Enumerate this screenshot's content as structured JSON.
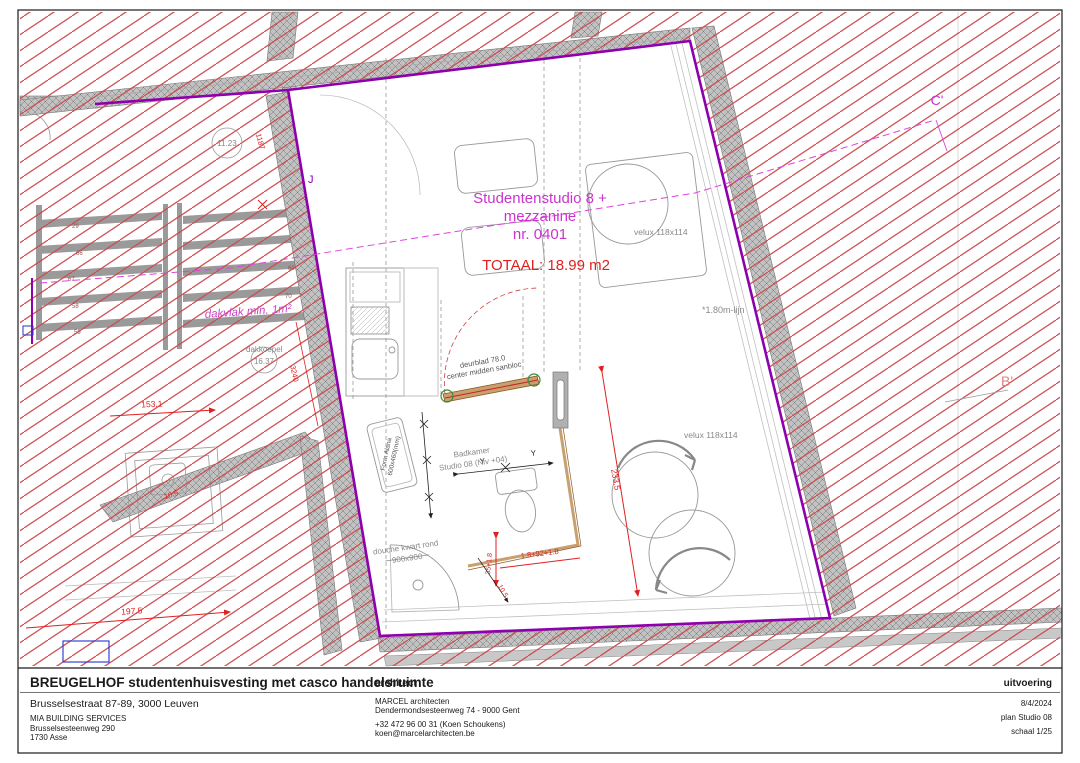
{
  "title_block": {
    "project": "BREUGELHOF studentenhuisvesting met casco handelsruimte",
    "address": "Brusselsestraat 87-89, 3000 Leuven",
    "client_name": "MIA BUILDING SERVICES",
    "client_street": "Brusselsesteenweg 290",
    "client_city": "1730 Asse",
    "architect_heading": "architect",
    "architect_name": "MARCEL architecten",
    "architect_address": "Dendermondsesteenweg 74 - 9000 Gent",
    "architect_phone": "+32 472 96 00 31 (Koen Schoukens)",
    "architect_email": "koen@marcelarchitecten.be",
    "phase": "uitvoering",
    "date": "8/4/2024",
    "plan_name": "plan Studio 08",
    "scale": "schaal 1/25"
  },
  "plan": {
    "studio_title_1": "Studentenstudio 8 +",
    "studio_title_2": "mezzanine",
    "studio_title_3": "nr. 0401",
    "total_area": "TOTAAL: 18.99 m2",
    "velux_top": "velux 118x114",
    "velux_mid": "velux 118x114",
    "line_180": "*1.80m-lijn",
    "badkamer_1": "Badkamer",
    "badkamer_2": "Studio 08 (Niv +04)",
    "deurblad_1": "deurblad 78.0",
    "deurblad_2": "center midden sanbloc",
    "douche_1": "douche kwart rond",
    "douche_2": "900x900",
    "form_alana_1": "Form Alana",
    "form_alana_2": "600x460(mm)",
    "dakvlak_note": "dakvlak min. 1m²",
    "dakkoepel_label": "dakkoepel",
    "dakkoepel_value": "16.37",
    "ref_circle_value": "11.23",
    "section_c": "C'",
    "section_b": "B'",
    "y_label": "Y",
    "dims": {
      "d2335": "233.5",
      "d1531": "153.1",
      "d1975": "197.5",
      "d105": "10.5",
      "d105b": "10.5",
      "d3518": "35+1.8",
      "d18921": "1.8+92+1.8",
      "d3240": "3240",
      "d1187": "1187"
    },
    "stair_numbers": [
      "29",
      "66",
      "67",
      "58",
      "59",
      "60",
      "70"
    ]
  },
  "colors": {
    "hatch_red": "#c53232",
    "boundary_purple": "#8e00ae",
    "label_magenta": "#cc33cc",
    "dim_red": "#e02020",
    "wall_gray": "#a8a8a8",
    "furniture_gray": "#999999",
    "door_tan": "#c8a070",
    "hinge_green": "#3a8a3a",
    "marker_blue": "#2233cc"
  }
}
